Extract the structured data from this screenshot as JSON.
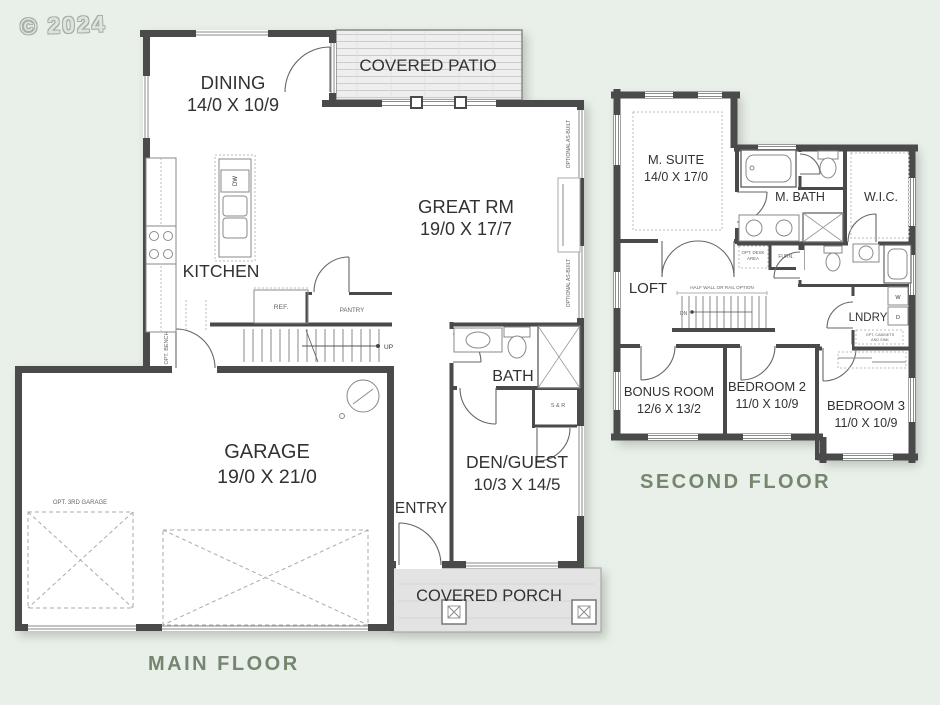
{
  "page": {
    "copyright": "© 2024"
  },
  "colors": {
    "background": "#e9efe9",
    "wall": "#4a4a4a",
    "floor_title": "#75866f"
  },
  "main_floor": {
    "title": "MAIN FLOOR",
    "dining_name": "DINING",
    "dining_dims": "14/0 X 10/9",
    "patio_name": "COVERED PATIO",
    "great_name": "GREAT RM",
    "great_dims": "19/0 X 17/7",
    "kitchen_name": "KITCHEN",
    "dw_label": "DW",
    "ref_label": "REF.",
    "pantry_label": "PANTRY",
    "opt_bench_label": "OPT. BENCH",
    "up_label": "UP",
    "optional_asbuilt_label": "OPTIONAL AS-BUILT",
    "bath_name": "BATH",
    "shelf_rod_label": "S & R",
    "den_name": "DEN/GUEST",
    "den_dims": "10/3 X 14/5",
    "entry_name": "ENTRY",
    "garage_name": "GARAGE",
    "garage_dims": "19/0 X 21/0",
    "opt_3rd_garage_label": "OPT. 3RD GARAGE",
    "porch_name": "COVERED PORCH"
  },
  "second_floor": {
    "title": "SECOND FLOOR",
    "msuite_name": "M. SUITE",
    "msuite_dims": "14/0 X 17/0",
    "mbath_name": "M. BATH",
    "wic_name": "W.I.C.",
    "loft_name": "LOFT",
    "halfwall_label": "HALF WALL OR RAIL OPTION",
    "dn_label": "DN",
    "optdesk_line1": "OPT. DESK",
    "optdesk_line2": "AREA",
    "furn_label": "FURN.",
    "lndry_name": "LNDRY",
    "washer_label": "W",
    "dryer_label": "D",
    "optcab_line1": "OPT. CABINETS",
    "optcab_line2": "AND SINK",
    "bonus_name": "BONUS ROOM",
    "bonus_dims": "12/6 X 13/2",
    "bed2_name": "BEDROOM 2",
    "bed2_dims": "11/0 X 10/9",
    "bed3_name": "BEDROOM 3",
    "bed3_dims": "11/0 X 10/9"
  }
}
